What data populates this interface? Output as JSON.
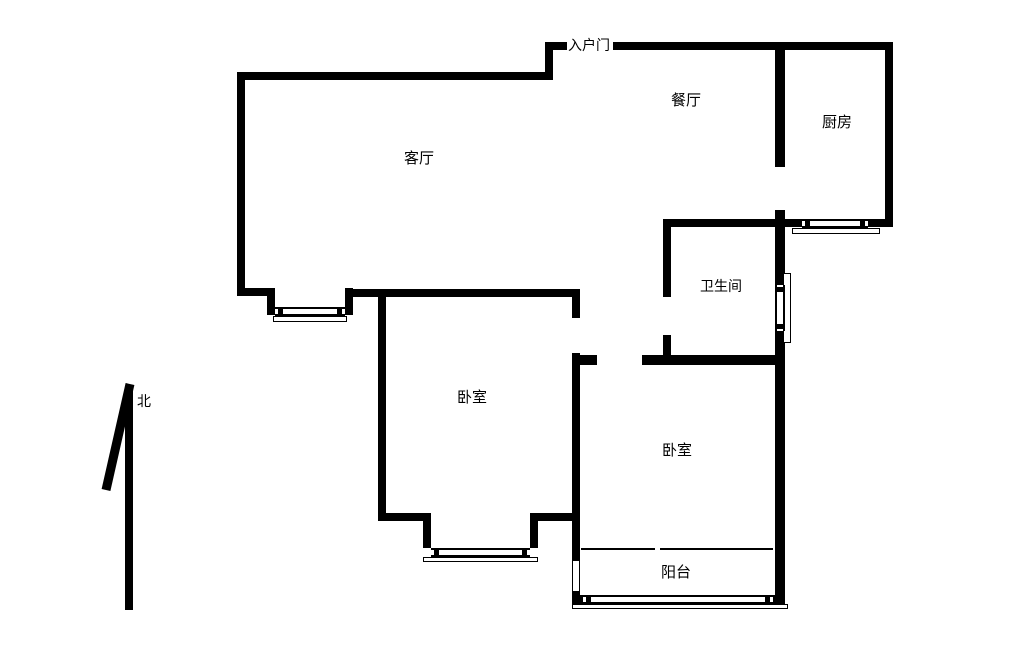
{
  "plan_title": "two-bedroom-apartment-floor-plan",
  "colors": {
    "background": "#ffffff",
    "wall": "#000000",
    "text": "#000000"
  },
  "labels": {
    "entrance": "入户门",
    "entrance_pos": {
      "x": 568,
      "y": 39,
      "size": 14
    },
    "north": "北",
    "north_pos": {
      "x": 137,
      "y": 395,
      "size": 14
    },
    "rooms": [
      {
        "name": "dining-room",
        "text": "餐厅",
        "x": 671,
        "y": 93,
        "size": 15
      },
      {
        "name": "kitchen",
        "text": "厨房",
        "x": 822,
        "y": 115,
        "size": 15
      },
      {
        "name": "living-room",
        "text": "客厅",
        "x": 404,
        "y": 151,
        "size": 15
      },
      {
        "name": "bathroom",
        "text": "卫生间",
        "x": 700,
        "y": 280,
        "size": 14
      },
      {
        "name": "bedroom-1",
        "text": "卧室",
        "x": 457,
        "y": 390,
        "size": 15
      },
      {
        "name": "bedroom-2",
        "text": "卧室",
        "x": 662,
        "y": 443,
        "size": 15
      },
      {
        "name": "balcony",
        "text": "阳台",
        "x": 661,
        "y": 565,
        "size": 15
      }
    ]
  },
  "geometry": {
    "walls": [
      {
        "name": "entry-jamb-left",
        "x": 545,
        "y": 42,
        "w": 22,
        "h": 8
      },
      {
        "name": "top-wall-right-of-door",
        "x": 613,
        "y": 42,
        "w": 280,
        "h": 8
      },
      {
        "name": "entry-step-connector",
        "x": 545,
        "y": 42,
        "w": 8,
        "h": 38
      },
      {
        "name": "living-top-wall",
        "x": 237,
        "y": 72,
        "w": 316,
        "h": 8
      },
      {
        "name": "living-left-wall",
        "x": 237,
        "y": 72,
        "w": 8,
        "h": 224
      },
      {
        "name": "living-bottom-left",
        "x": 237,
        "y": 288,
        "w": 38,
        "h": 8
      },
      {
        "name": "bay-step-left",
        "x": 267,
        "y": 288,
        "w": 8,
        "h": 27
      },
      {
        "name": "bay-step-right",
        "x": 345,
        "y": 288,
        "w": 8,
        "h": 27
      },
      {
        "name": "living-bottom-wall",
        "x": 345,
        "y": 289,
        "w": 235,
        "h": 8
      },
      {
        "name": "bedroom1-left-wall",
        "x": 378,
        "y": 290,
        "w": 8,
        "h": 231
      },
      {
        "name": "bedroom1-right-upper",
        "x": 572,
        "y": 290,
        "w": 8,
        "h": 28
      },
      {
        "name": "bedroom1-right-lower",
        "x": 572,
        "y": 353,
        "w": 8,
        "h": 168
      },
      {
        "name": "bedroom2-door-stub",
        "x": 580,
        "y": 355,
        "w": 17,
        "h": 10
      },
      {
        "name": "bathroom-bottom-wall",
        "x": 642,
        "y": 355,
        "w": 143,
        "h": 10
      },
      {
        "name": "bathroom-left-upper",
        "x": 663,
        "y": 219,
        "w": 8,
        "h": 78
      },
      {
        "name": "bathroom-left-lower",
        "x": 663,
        "y": 335,
        "w": 8,
        "h": 22
      },
      {
        "name": "bathroom-top-wall",
        "x": 663,
        "y": 219,
        "w": 122,
        "h": 8
      },
      {
        "name": "kitchen-divider-wall",
        "x": 775,
        "y": 48,
        "w": 10,
        "h": 119
      },
      {
        "name": "right-wall-mid",
        "x": 775,
        "y": 210,
        "w": 10,
        "h": 75
      },
      {
        "name": "right-wall-lower",
        "x": 775,
        "y": 331,
        "w": 10,
        "h": 274
      },
      {
        "name": "kitchen-bottom-left",
        "x": 785,
        "y": 219,
        "w": 17,
        "h": 8
      },
      {
        "name": "kitchen-bottom-right",
        "x": 868,
        "y": 219,
        "w": 25,
        "h": 8
      },
      {
        "name": "outer-right-wall",
        "x": 885,
        "y": 42,
        "w": 8,
        "h": 185
      },
      {
        "name": "bedroom1-bottom-left",
        "x": 378,
        "y": 513,
        "w": 53,
        "h": 8
      },
      {
        "name": "bedroom1-bay-step-left",
        "x": 423,
        "y": 513,
        "w": 8,
        "h": 35
      },
      {
        "name": "bedroom1-bay-step-right",
        "x": 530,
        "y": 513,
        "w": 8,
        "h": 35
      },
      {
        "name": "bedroom1-bottom-right",
        "x": 538,
        "y": 513,
        "w": 42,
        "h": 8
      },
      {
        "name": "balcony-left-upper",
        "x": 572,
        "y": 521,
        "w": 8,
        "h": 39
      },
      {
        "name": "balcony-left-lower",
        "x": 572,
        "y": 592,
        "w": 8,
        "h": 13
      },
      {
        "name": "balcony-bottom-left-corner",
        "x": 572,
        "y": 595,
        "w": 11,
        "h": 10
      },
      {
        "name": "balcony-bottom-right-corner",
        "x": 770,
        "y": 595,
        "w": 15,
        "h": 10
      }
    ],
    "windows_h": [
      {
        "name": "living-bay-window",
        "x": 275,
        "y": 307,
        "w": 70,
        "h": 9,
        "caps": true
      },
      {
        "name": "kitchen-window",
        "x": 802,
        "y": 219,
        "w": 66,
        "h": 9,
        "caps": true
      },
      {
        "name": "bedroom1-window",
        "x": 431,
        "y": 548,
        "w": 99,
        "h": 9,
        "caps": true
      },
      {
        "name": "balcony-window",
        "x": 583,
        "y": 595,
        "w": 190,
        "h": 9,
        "caps": true
      }
    ],
    "windows_v": [
      {
        "name": "bathroom-window",
        "x": 775,
        "y": 285,
        "w": 10,
        "h": 46,
        "caps": true
      },
      {
        "name": "balcony-side-window",
        "x": 572,
        "y": 560,
        "w": 8,
        "h": 32,
        "caps": false
      }
    ],
    "sills": [
      {
        "name": "living-bay-sill",
        "x": 273,
        "y": 316,
        "w": 74,
        "h": 6
      },
      {
        "name": "kitchen-sill",
        "x": 792,
        "y": 228,
        "w": 88,
        "h": 6
      },
      {
        "name": "bedroom1-sill",
        "x": 423,
        "y": 557,
        "w": 115,
        "h": 5
      },
      {
        "name": "balcony-sill",
        "x": 572,
        "y": 604,
        "w": 216,
        "h": 5
      },
      {
        "name": "bathroom-sill",
        "x": 783,
        "y": 273,
        "w": 8,
        "h": 70
      }
    ],
    "thin_lines": [
      {
        "name": "balcony-divider-left",
        "x": 581,
        "y": 548,
        "w": 74,
        "h": 2
      },
      {
        "name": "balcony-divider-right",
        "x": 660,
        "y": 548,
        "w": 113,
        "h": 2
      }
    ],
    "north_arrow": {
      "x": 95,
      "y": 378,
      "w": 60,
      "h": 240
    }
  }
}
